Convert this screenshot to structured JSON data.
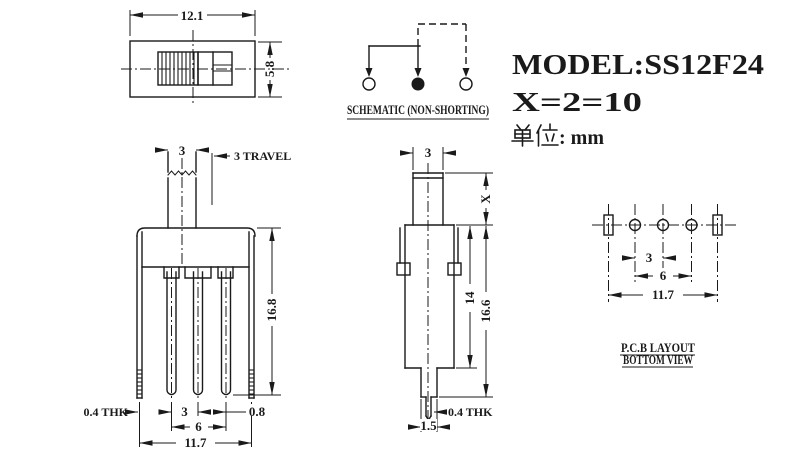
{
  "title_block": {
    "model": "MODEL:SS12F24",
    "x_spec": "X=2=10",
    "unit_label": "单位",
    "unit_suffix": ": mm",
    "unit_full": "单位: mm"
  },
  "schematic": {
    "title": "SCHEMATIC (NON-SHORTING)"
  },
  "top_view": {
    "dim_width": "12.1",
    "dim_height": "5.8"
  },
  "front_view": {
    "dim_knob": "3",
    "dim_travel": "3 TRAVEL",
    "dim_height": "16.8",
    "dim_thk": "0.4 THK",
    "dim_pitch": "3",
    "dim_span": "6",
    "dim_gap": "0.8",
    "dim_width": "11.7"
  },
  "side_view": {
    "dim_knob": "3",
    "dim_x": "X",
    "dim_body": "14",
    "dim_total": "16.6",
    "dim_thk": "0.4 THK",
    "dim_pin": "1.5"
  },
  "pcb_view": {
    "title1": "P.C.B LAYOUT",
    "title2": "BOTTOM VIEW",
    "dim_pitch": "3",
    "dim_span": "6",
    "dim_width": "11.7"
  }
}
